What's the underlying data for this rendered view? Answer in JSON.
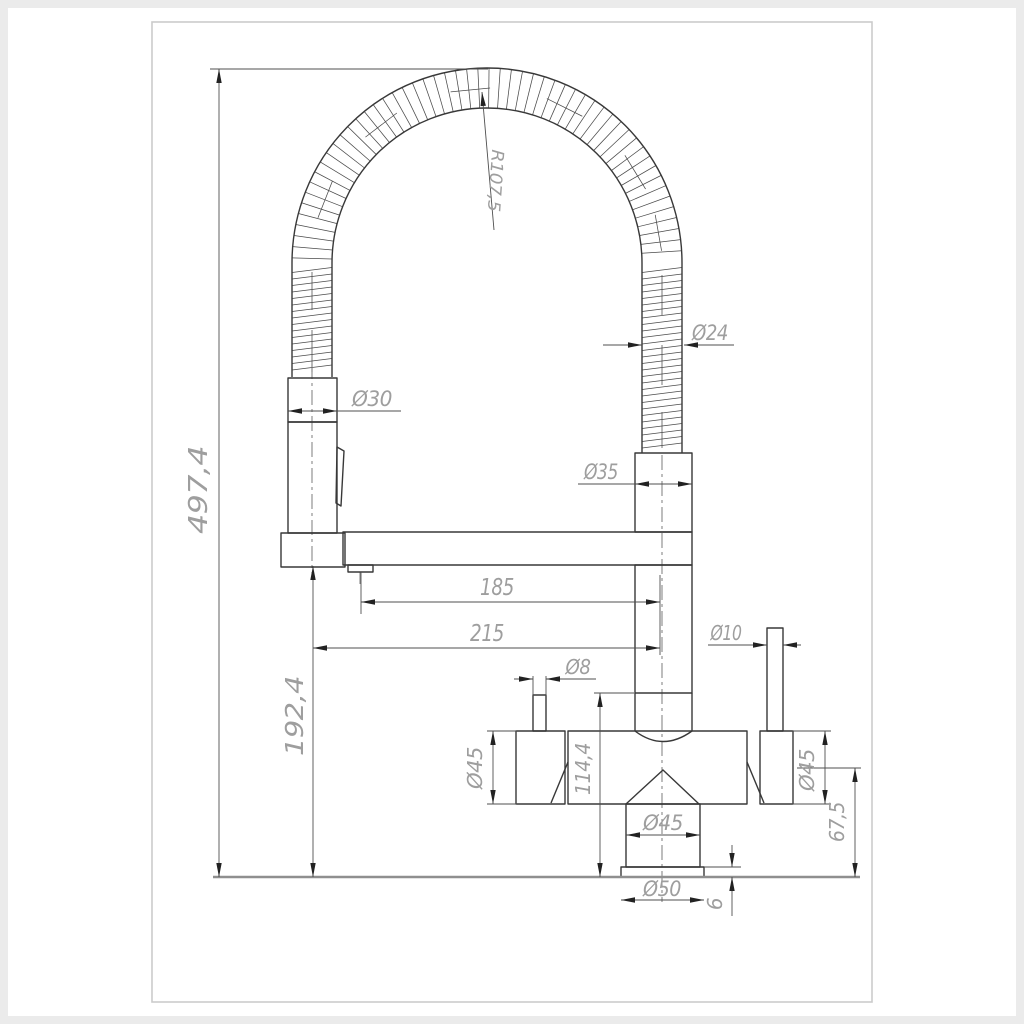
{
  "drawing": {
    "kind": "technical-dimension-drawing",
    "subject": "kitchen mixer faucet with flexible spring pull-down spout, front elevation",
    "dimensions": {
      "overall_height": "497,4",
      "outlet_height": "192,4",
      "reach_total": "215",
      "reach_outlet": "185",
      "spring_radius": "R107,5",
      "hose_diameter": "Ø24",
      "sprayhead_diameter": "Ø30",
      "connector_diameter": "Ø35",
      "inlet_top_height": "114,4",
      "left_lever_diameter": "Ø8",
      "right_lever_diameter": "Ø10",
      "body_left_diameter": "Ø45",
      "body_right_diameter": "Ø45",
      "base_shaft_diameter": "Ø45",
      "base_flange_diameter": "Ø50",
      "body_axis_height": "67,5",
      "base_flange_thickness": "6"
    },
    "colors": {
      "outline": "#383838",
      "dimension_lines": "#4f4f4f",
      "dimension_text": "#9e9e9e",
      "counter_line": "#8f8f8f",
      "sheet_frame": "#cbcbcb",
      "background": "#ffffff",
      "page_edge": "#ebebeb"
    }
  }
}
